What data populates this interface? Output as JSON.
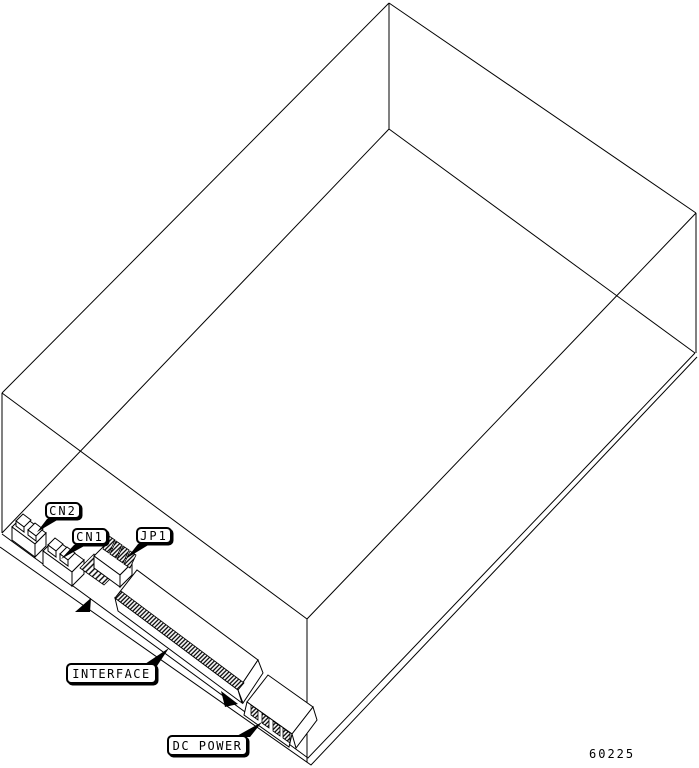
{
  "diagram": {
    "alt_text": "Isometric wireframe drawing of a disk drive enclosure with connector callouts",
    "background": "#ffffff",
    "line_color": "#000000",
    "callouts": [
      {
        "id": "cn2",
        "label": "CN2"
      },
      {
        "id": "cn1",
        "label": "CN1"
      },
      {
        "id": "jp1",
        "label": "JP1"
      },
      {
        "id": "interface",
        "label": "INTERFACE"
      },
      {
        "id": "dc_power",
        "label": "DC POWER"
      }
    ],
    "figure_number": "60225"
  }
}
